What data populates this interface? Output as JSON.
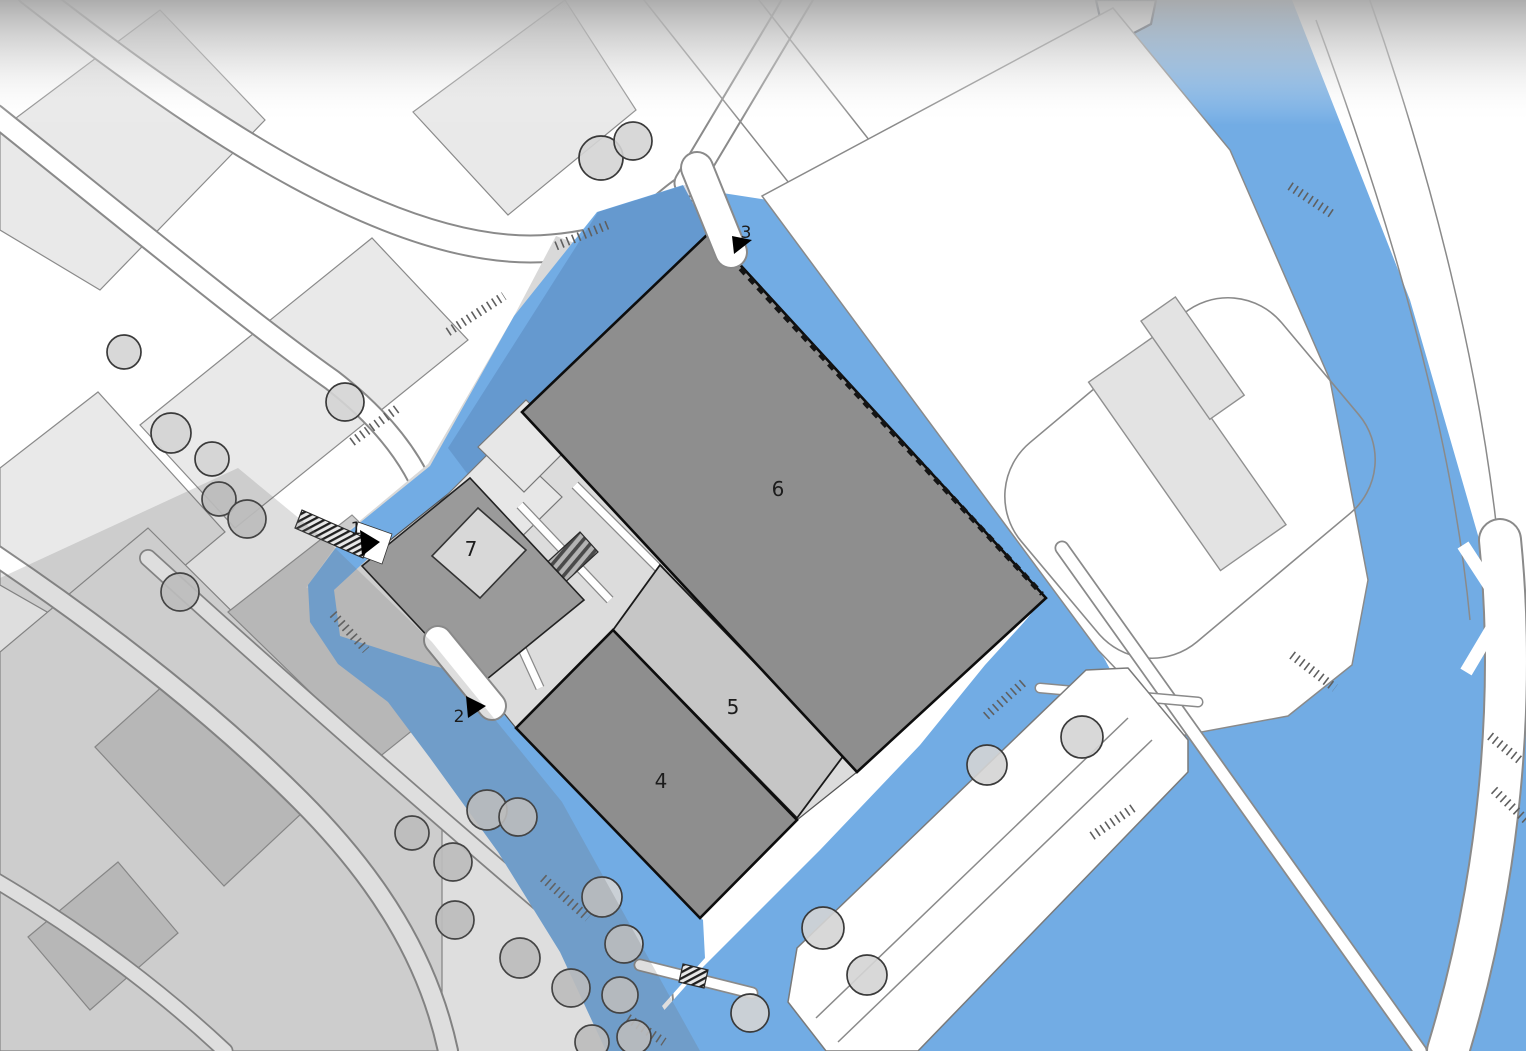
{
  "map": {
    "title": "site-plan",
    "labels": {
      "building_4": "4",
      "building_5": "5",
      "building_6": "6",
      "building_7": "7",
      "entrance_1": "1",
      "entrance_2": "2",
      "entrance_3": "3"
    },
    "colors": {
      "water": "#72ace4",
      "parcel": "#e9e9e9",
      "building-dark": "#8e8e8e",
      "building-mid": "#c6c6c6",
      "building-light": "#e3e3e3",
      "podium": "#9a9a9a",
      "courtyard": "#dcdcdc",
      "outline": "#0d0d0d",
      "road-line": "#8a8a8a",
      "tree-fill": "#d4d4d4",
      "tree-stroke": "#3a3a3a",
      "label": "#1c1c1c",
      "marker": "#000000",
      "chevron": "#ffffff"
    }
  }
}
